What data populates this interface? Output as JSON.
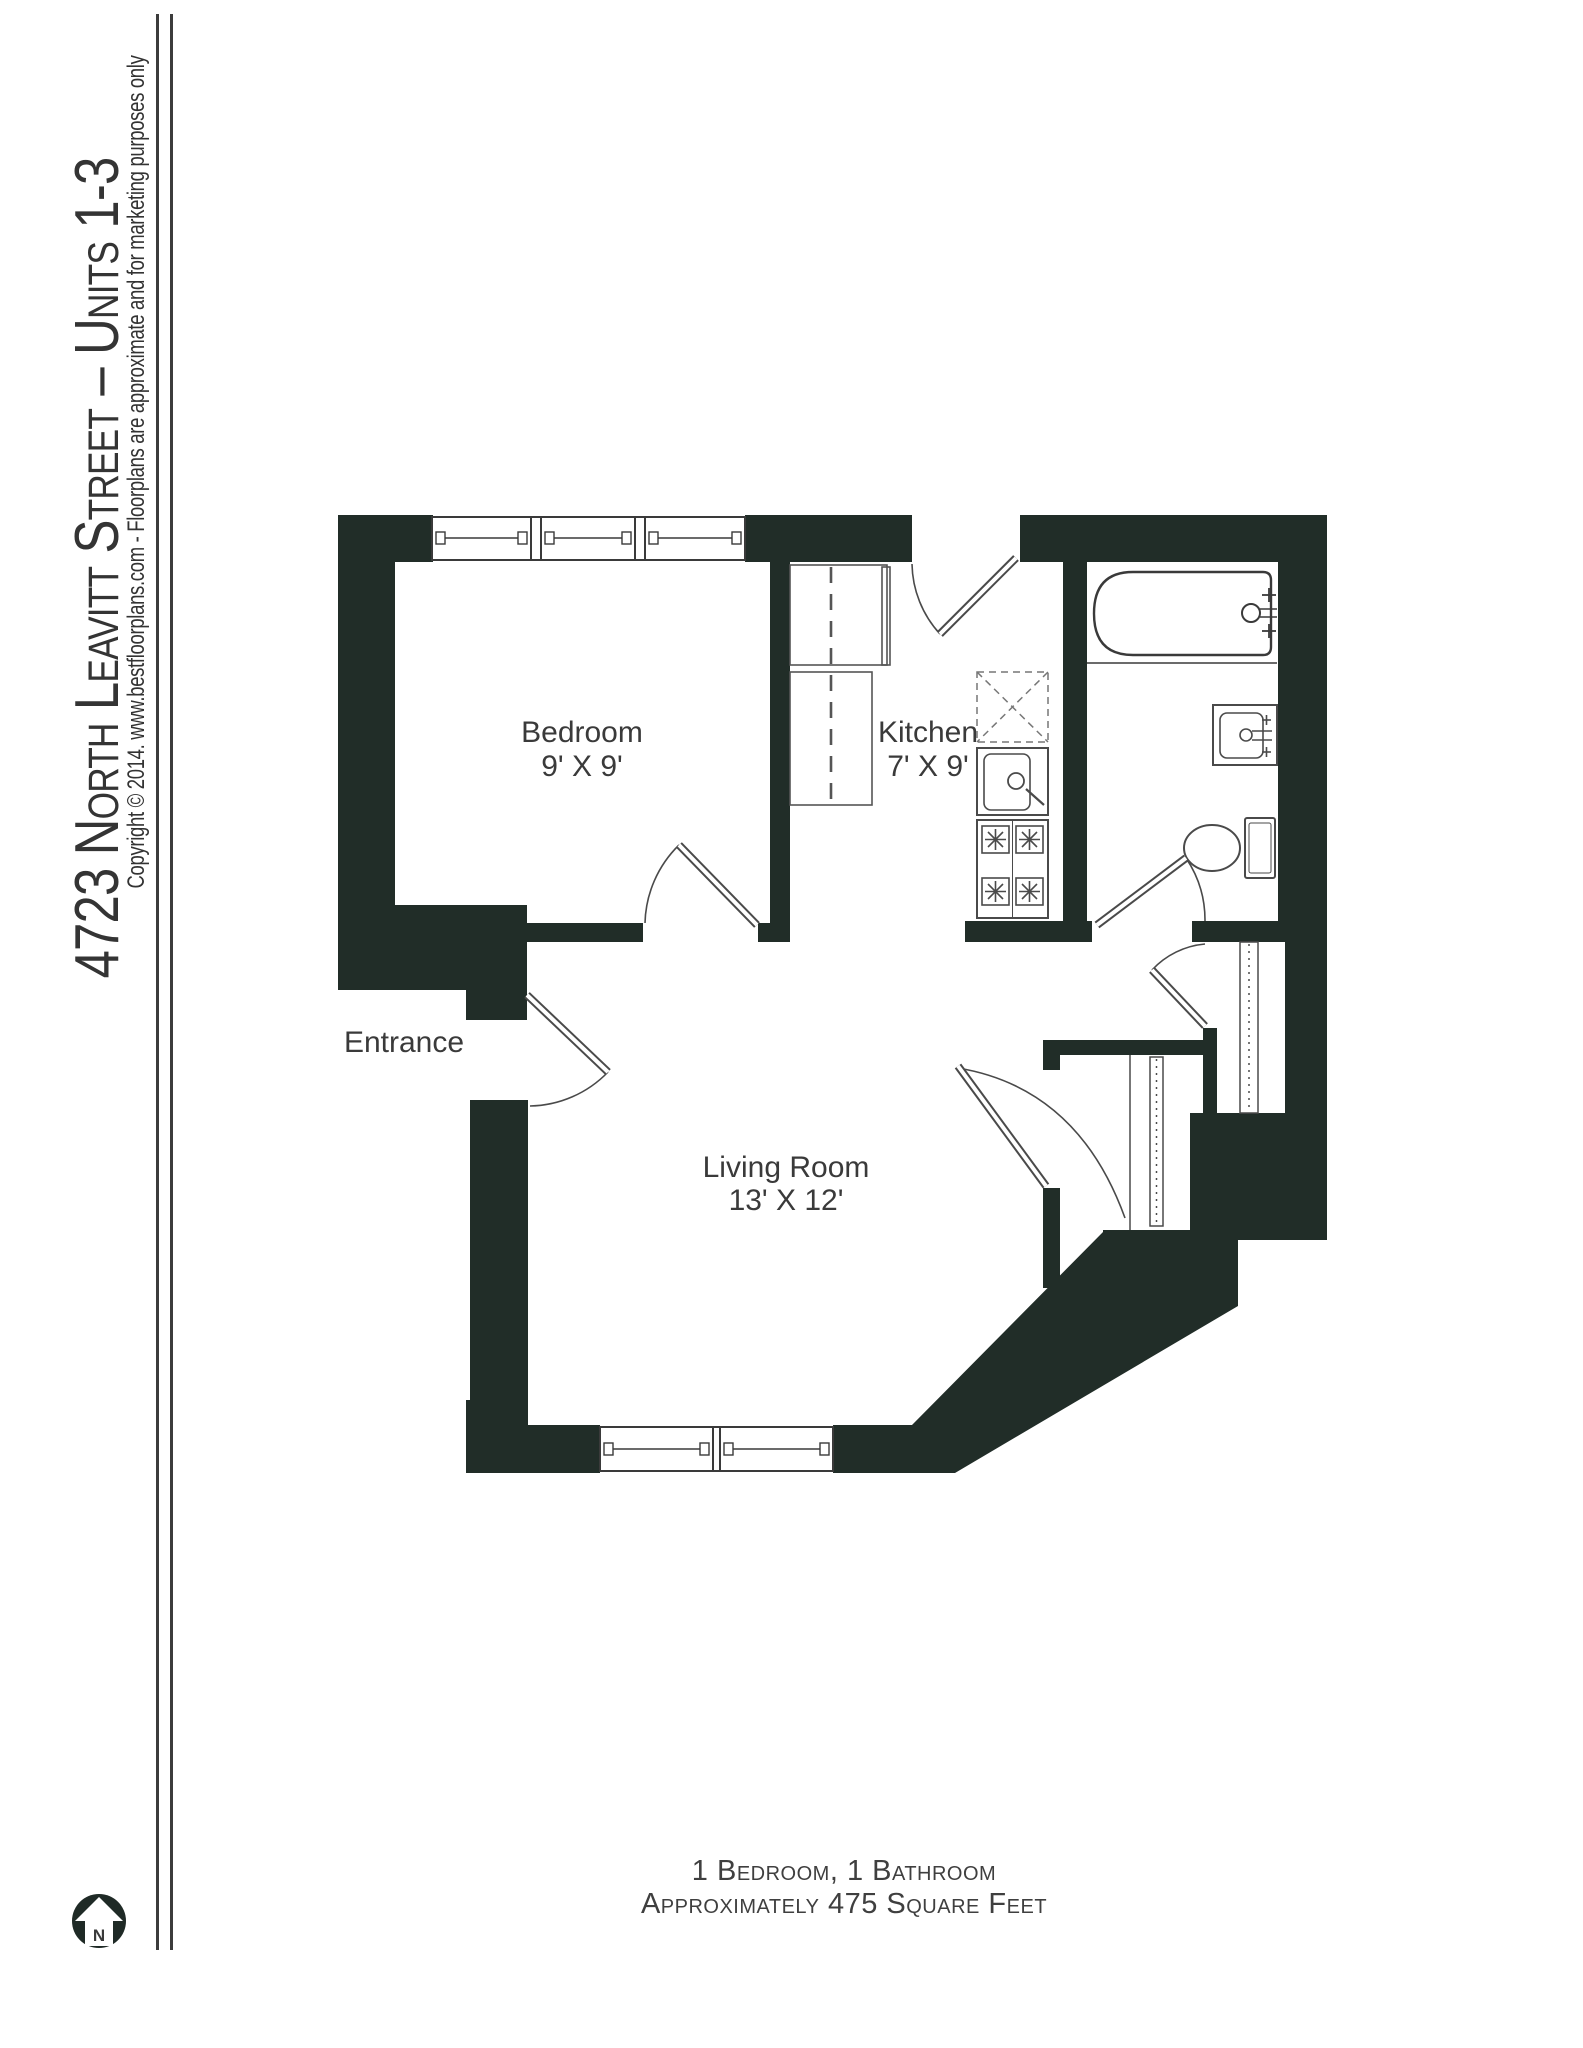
{
  "sidebar": {
    "title": "4723 North Leavitt Street – Units 1-3",
    "copyright": "Copyright © 2014. www.bestfloorplans.com - Floorplans are approximate and for marketing purposes only"
  },
  "plan": {
    "rooms": {
      "bedroom": {
        "name": "Bedroom",
        "dims": "9' X 9'"
      },
      "kitchen": {
        "name": "Kitchen",
        "dims": "7' X 9'"
      },
      "living_room": {
        "name": "Living Room",
        "dims": "13' X 12'"
      },
      "entrance": {
        "name": "Entrance"
      }
    },
    "north_arrow_label": "N",
    "fixtures": [
      "bathtub",
      "bathroom-sink",
      "toilet",
      "kitchen-sink",
      "stove",
      "kitchen-counter",
      "closet-shelves",
      "windows",
      "doors"
    ]
  },
  "footer": {
    "line1": "1 Bedroom, 1 Bathroom",
    "line2": "Approximately 475 Square Feet"
  },
  "colors": {
    "wall": "#212d28",
    "fixture_line": "#4a4a4a",
    "text": "#3a3a3a",
    "background": "#ffffff"
  }
}
